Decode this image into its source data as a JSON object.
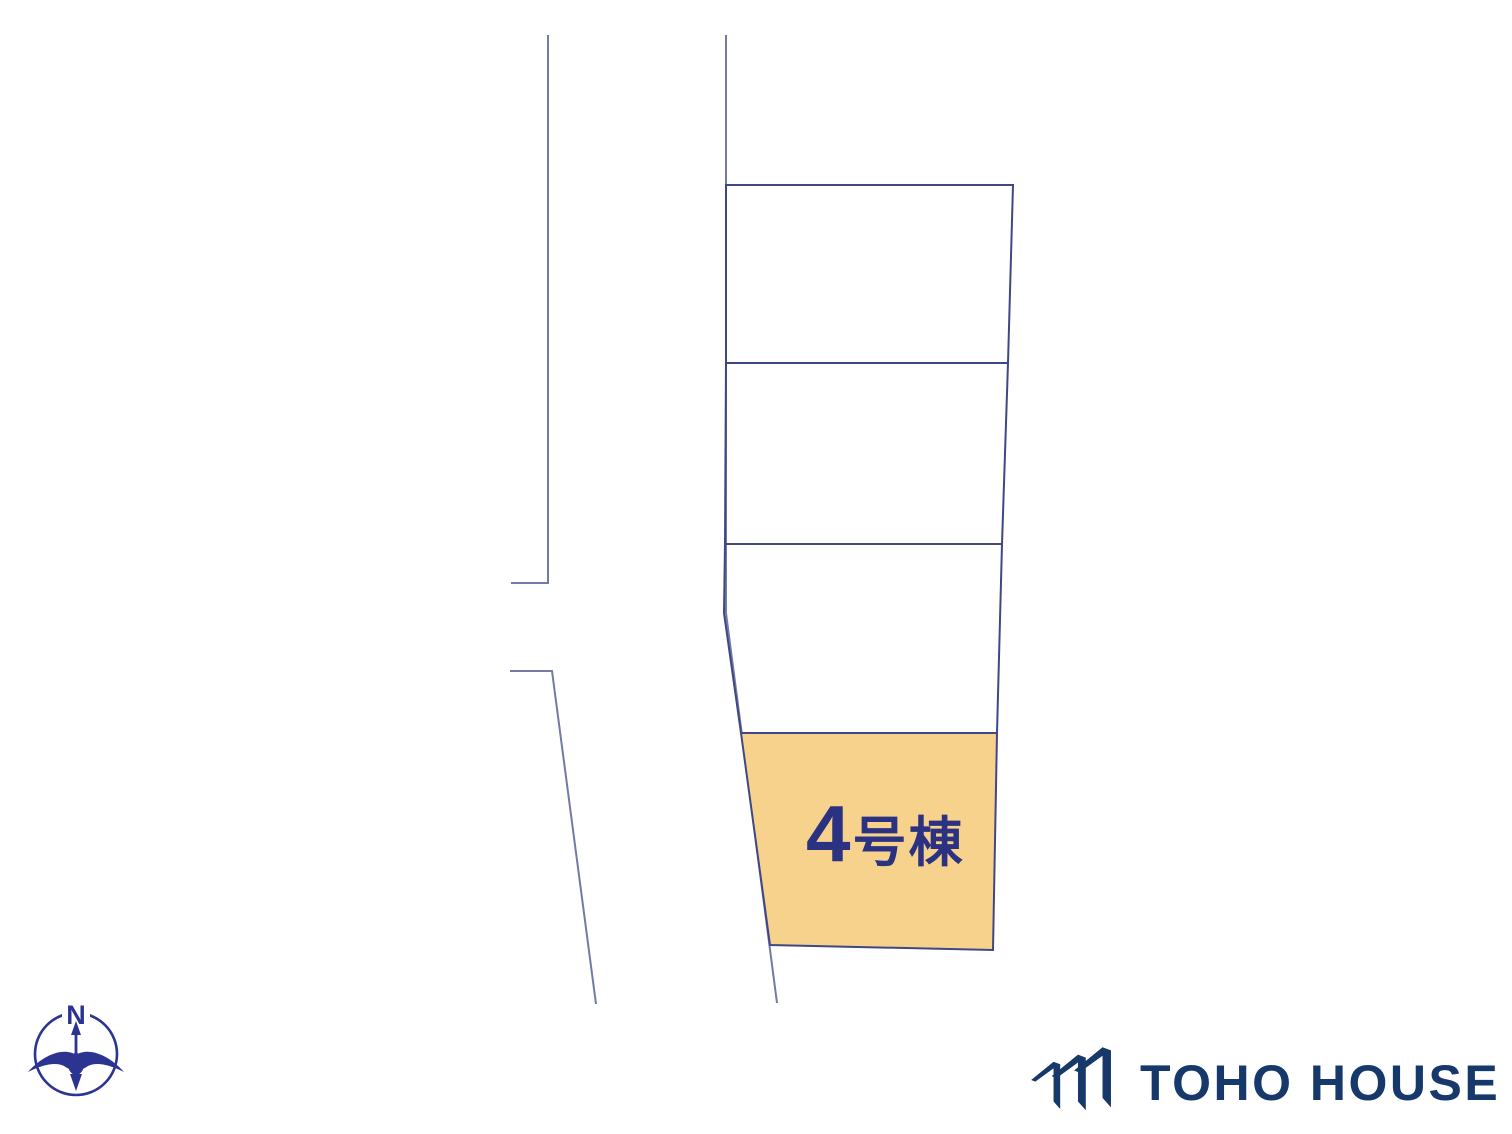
{
  "plan": {
    "line_color": "#3f4784",
    "road_line_color": "#7479a8",
    "highlight_fill": "#f7d28d",
    "roads": [
      {
        "name": "road-edge-left-upper",
        "points": "548,35 548,583 511,583"
      },
      {
        "name": "road-edge-left-lower",
        "points": "510,671 552,671 596,1004"
      },
      {
        "name": "road-edge-right",
        "points": "726,35 726,613 777,1003"
      }
    ],
    "plots": [
      {
        "name": "plot-1",
        "points": "726,185 1013,185 1008,363 726,363",
        "fill": "none"
      },
      {
        "name": "plot-2",
        "points": "726,363 1008,363 1002,544 725,544",
        "fill": "none"
      },
      {
        "name": "plot-3",
        "points": "725,544 1002,544 997,733 741,733 724,613",
        "fill": "none"
      },
      {
        "name": "plot-4",
        "points": "741,733 997,733 993,950 770,945",
        "fill": "#f7d28d"
      }
    ]
  },
  "labels": {
    "unit_number": "4",
    "unit_suffix": "号棟",
    "text_color": "#2b3282"
  },
  "compass": {
    "letter": "N",
    "color": "#2b3490"
  },
  "brand": {
    "name": "TOHO HOUSE",
    "color": "#17386a"
  }
}
